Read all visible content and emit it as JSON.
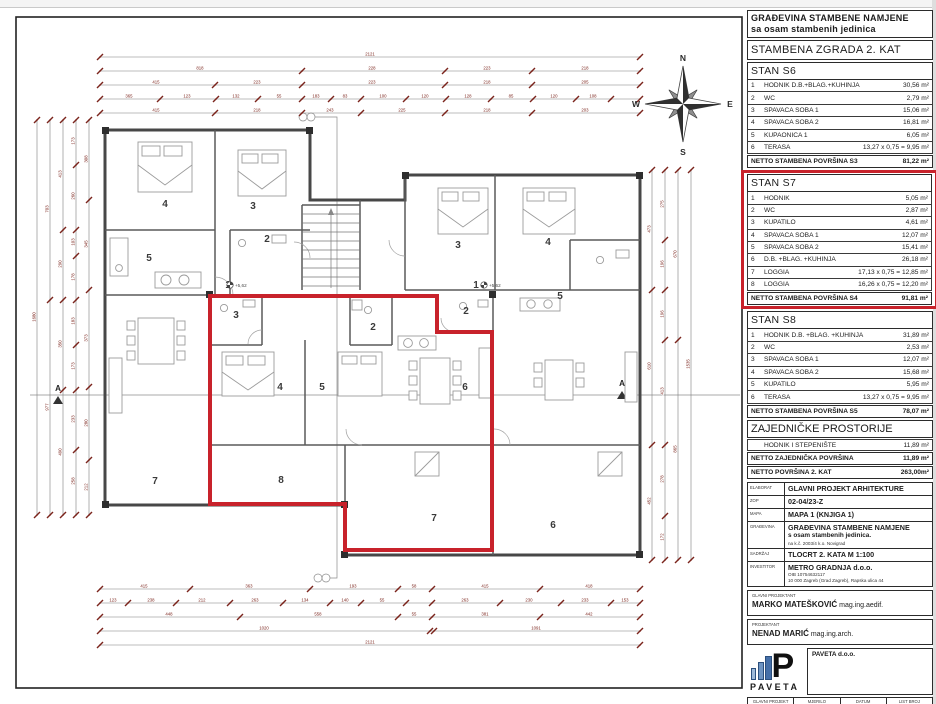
{
  "panel": {
    "header_line1": "GRAĐEVINA STAMBENE NAMJENE",
    "header_line2": "sa osam stambenih jedinica",
    "subtitle": "STAMBENA ZGRADA 2. KAT",
    "sections": [
      {
        "title": "STAN S6",
        "rows": [
          {
            "num": "1",
            "label": "HODNIK D.B.+BLAG.+KUHINJA",
            "area": "30,56 m²"
          },
          {
            "num": "2",
            "label": "WC",
            "area": "2,79 m²"
          },
          {
            "num": "3",
            "label": "SPAVAĆA SOBA 1",
            "area": "15,06 m²"
          },
          {
            "num": "4",
            "label": "SPAVAĆA SOBA 2",
            "area": "16,81 m²"
          },
          {
            "num": "5",
            "label": "KUPAONICA 1",
            "area": "6,05 m²"
          },
          {
            "num": "6",
            "label": "TERASA",
            "area": "13,27 x 0,75 = 9,95 m²"
          }
        ],
        "total_label": "NETTO STAMBENA POVRŠINA S3",
        "total_area": "81,22 m²"
      },
      {
        "title": "STAN S7",
        "rows": [
          {
            "num": "1",
            "label": "HODNIK",
            "area": "5,05 m²"
          },
          {
            "num": "2",
            "label": "WC",
            "area": "2,87 m²"
          },
          {
            "num": "3",
            "label": "KUPATILO",
            "area": "4,61 m²"
          },
          {
            "num": "4",
            "label": "SPAVAĆA SOBA 1",
            "area": "12,07 m²"
          },
          {
            "num": "5",
            "label": "SPAVAĆA SOBA 2",
            "area": "15,41 m²"
          },
          {
            "num": "6",
            "label": "D.B. +BLAG. +KUHINJA",
            "area": "26,18 m²"
          },
          {
            "num": "7",
            "label": "LOGGIA",
            "area": "17,13 x 0,75 = 12,85 m²"
          },
          {
            "num": "8",
            "label": "LOGGIA",
            "area": "16,26 x 0,75 = 12,20 m²"
          }
        ],
        "total_label": "NETTO STAMBENA POVRŠINA S4",
        "total_area": "91,81 m²"
      },
      {
        "title": "STAN S8",
        "rows": [
          {
            "num": "1",
            "label": "HODNIK D.B. +BLAG. +KUHINJA",
            "area": "31,89 m²"
          },
          {
            "num": "2",
            "label": "WC",
            "area": "2,53 m²"
          },
          {
            "num": "3",
            "label": "SPAVAĆA SOBA 1",
            "area": "12,07 m²"
          },
          {
            "num": "4",
            "label": "SPAVAĆA SOBA 2",
            "area": "15,68 m²"
          },
          {
            "num": "5",
            "label": "KUPATILO",
            "area": "5,95 m²"
          },
          {
            "num": "6",
            "label": "TERASA",
            "area": "13,27 x 0,75 = 9,95 m²"
          }
        ],
        "total_label": "NETTO STAMBENA POVRŠINA S5",
        "total_area": "78,07 m²"
      }
    ],
    "common": {
      "title": "ZAJEDNIČKE PROSTORIJE",
      "row_label": "HODNIK I STEPENIŠTE",
      "row_area": "11,89 m²",
      "total1_label": "NETTO ZAJEDNIČKA POVRŠINA",
      "total1_area": "11,89 m²",
      "total2_label": "NETTO POVRŠINA 2. KAT",
      "total2_area": "263,00m²"
    },
    "titleblock": {
      "k1": "ELABORAT",
      "v1": "GLAVNI PROJEKT ARHITEKTURE",
      "k2": "ZOP",
      "v2": "02-04/23-Z",
      "k3": "MAPA",
      "v3": "MAPA 1 (KNJIGA 1)",
      "k4": "GRAĐEVINA",
      "v4": "GRAĐEVINA STAMBENE NAMJENE",
      "v4b": "s osam stambenih jedinica.",
      "v4c": "na k.č. 2003/4 k.o. Novigrad",
      "k5": "SADRŽAJ",
      "v5": "TLOCRT 2. KATA M 1:100",
      "k6": "INVESTITOR",
      "v6": "METRO GRADNJA d.o.o.",
      "v6b": "OIB 10754632117",
      "v6c": "10 000 Zagreb (Grad Zagreb), Rapska ulica 44",
      "gp_label": "GLAVNI PROJEKTANT",
      "gp_name": "MARKO MATEŠKOVIĆ",
      "gp_title": " mag.ing.aedif.",
      "p_label": "PROJEKTANT",
      "p_name": "NENAD MARIĆ",
      "p_title": " mag.ing.arch.",
      "logo_letter": "P",
      "logo_word": "PAVETA",
      "company_name": "PAVETA d.o.o.",
      "company_lines": [
        "CRNTAVICA 35.",
        "GRŽEVIĆI, 52444 TINJAN",
        "tel. +385 91 529 1936",
        "e-mail: marko@pa-v.hr",
        "OIB: 27493677046"
      ],
      "footer": [
        {
          "label": "GLAVNI PROJEKT",
          "value": "02/04/2023"
        },
        {
          "label": "MJERILO",
          "value": "1:100"
        },
        {
          "label": "DATUM",
          "value": "05/2023"
        },
        {
          "label": "LIST BROJ",
          "value": "5"
        }
      ]
    }
  },
  "plan": {
    "colors": {
      "highlight": "#c8222b",
      "dimension": "#7b241c",
      "walls": "#474747"
    },
    "compass": [
      {
        "t": "N",
        "x": 683,
        "y": 61
      },
      {
        "t": "E",
        "x": 730,
        "y": 107
      },
      {
        "t": "S",
        "x": 683,
        "y": 155
      },
      {
        "t": "W",
        "x": 636,
        "y": 107
      }
    ],
    "rooms": [
      {
        "n": "4",
        "x": 165,
        "y": 207
      },
      {
        "n": "3",
        "x": 253,
        "y": 209
      },
      {
        "n": "5",
        "x": 149,
        "y": 261
      },
      {
        "n": "2",
        "x": 267,
        "y": 242
      },
      {
        "n": "1",
        "x": 228,
        "y": 288
      },
      {
        "n": "3",
        "x": 458,
        "y": 248
      },
      {
        "n": "4",
        "x": 548,
        "y": 245
      },
      {
        "n": "1",
        "x": 476,
        "y": 288
      },
      {
        "n": "5",
        "x": 560,
        "y": 299
      },
      {
        "n": "2",
        "x": 466,
        "y": 314
      },
      {
        "n": "3",
        "x": 236,
        "y": 318
      },
      {
        "n": "2",
        "x": 373,
        "y": 330
      },
      {
        "n": "4",
        "x": 280,
        "y": 390
      },
      {
        "n": "5",
        "x": 322,
        "y": 390
      },
      {
        "n": "6",
        "x": 465,
        "y": 390
      },
      {
        "n": "7",
        "x": 155,
        "y": 484
      },
      {
        "n": "8",
        "x": 281,
        "y": 483
      },
      {
        "n": "7",
        "x": 434,
        "y": 521
      },
      {
        "n": "6",
        "x": 553,
        "y": 528
      }
    ],
    "level_marks": [
      {
        "t": "+5,62",
        "x": 238,
        "y": 287
      },
      {
        "t": "+5,62",
        "x": 492,
        "y": 287
      }
    ],
    "section_letters": [
      {
        "t": "A",
        "x": 58,
        "y": 391
      },
      {
        "t": "A",
        "x": 622,
        "y": 386
      }
    ],
    "dim_lines": [
      {
        "o": "h",
        "p": 57,
        "a": 100,
        "b": 640,
        "t": [
          100,
          640
        ],
        "l": [
          [
            "2121",
            370
          ]
        ]
      },
      {
        "o": "h",
        "p": 71,
        "a": 100,
        "b": 640,
        "t": [
          100,
          302,
          445,
          532,
          640
        ],
        "l": [
          [
            "818",
            200
          ],
          [
            "228",
            372
          ],
          [
            "223",
            487
          ],
          [
            "218",
            585
          ]
        ]
      },
      {
        "o": "h",
        "p": 85,
        "a": 100,
        "b": 640,
        "t": [
          100,
          215,
          302,
          445,
          532,
          640
        ],
        "l": [
          [
            "415",
            156
          ],
          [
            "223",
            257
          ],
          [
            "223",
            372
          ],
          [
            "218",
            487
          ],
          [
            "205",
            585
          ]
        ]
      },
      {
        "o": "h",
        "p": 99,
        "a": 100,
        "b": 640,
        "t": [
          100,
          160,
          216,
          258,
          302,
          331,
          361,
          406,
          446,
          491,
          533,
          576,
          611,
          640
        ],
        "l": [
          [
            "365",
            129
          ],
          [
            "123",
            187
          ],
          [
            "132",
            236
          ],
          [
            "55",
            279
          ],
          [
            "183",
            316
          ],
          [
            "83",
            345
          ],
          [
            "100",
            383
          ],
          [
            "120",
            425
          ],
          [
            "128",
            468
          ],
          [
            "85",
            511
          ],
          [
            "120",
            554
          ],
          [
            "108",
            593
          ]
        ]
      },
      {
        "o": "h",
        "p": 113,
        "a": 100,
        "b": 640,
        "t": [
          100,
          215,
          302,
          361,
          445,
          532,
          640
        ],
        "l": [
          [
            "415",
            156
          ],
          [
            "218",
            257
          ],
          [
            "243",
            330
          ],
          [
            "225",
            402
          ],
          [
            "218",
            487
          ],
          [
            "203",
            585
          ]
        ]
      },
      {
        "o": "h",
        "p": 589,
        "a": 100,
        "b": 640,
        "t": [
          100,
          190,
          310,
          398,
          432,
          540,
          640
        ],
        "l": [
          [
            "415",
            144
          ],
          [
            "363",
            249
          ],
          [
            "193",
            353
          ],
          [
            "58",
            414
          ],
          [
            "415",
            485
          ],
          [
            "418",
            589
          ]
        ]
      },
      {
        "o": "h",
        "p": 603,
        "a": 100,
        "b": 640,
        "t": [
          100,
          128,
          176,
          230,
          283,
          330,
          361,
          406,
          432,
          500,
          561,
          611,
          640
        ],
        "l": [
          [
            "123",
            113
          ],
          [
            "238",
            151
          ],
          [
            "212",
            202
          ],
          [
            "263",
            255
          ],
          [
            "134",
            305
          ],
          [
            "140",
            345
          ],
          [
            "55",
            382
          ],
          [
            "263",
            465
          ],
          [
            "230",
            529
          ],
          [
            "233",
            585
          ],
          [
            "153",
            625
          ]
        ]
      },
      {
        "o": "h",
        "p": 617,
        "a": 100,
        "b": 640,
        "t": [
          100,
          240,
          398,
          432,
          540,
          640
        ],
        "l": [
          [
            "448",
            169
          ],
          [
            "558",
            318
          ],
          [
            "55",
            414
          ],
          [
            "381",
            485
          ],
          [
            "442",
            589
          ]
        ]
      },
      {
        "o": "h",
        "p": 631,
        "a": 100,
        "b": 640,
        "t": [
          100,
          430,
          434,
          640
        ],
        "l": [
          [
            "1020",
            264
          ],
          [
            "1091",
            536
          ]
        ]
      },
      {
        "o": "h",
        "p": 645,
        "a": 100,
        "b": 640,
        "t": [
          100,
          640
        ],
        "l": [
          [
            "2121",
            370
          ]
        ]
      },
      {
        "o": "v",
        "p": 37,
        "a": 120,
        "b": 515,
        "t": [
          120,
          515
        ],
        "l": [
          [
            "1680",
            317
          ]
        ]
      },
      {
        "o": "v",
        "p": 50,
        "a": 120,
        "b": 515,
        "t": [
          120,
          300,
          515
        ],
        "l": [
          [
            "703",
            209
          ],
          [
            "977",
            407
          ]
        ]
      },
      {
        "o": "v",
        "p": 63,
        "a": 120,
        "b": 515,
        "t": [
          120,
          230,
          300,
          390,
          515
        ],
        "l": [
          [
            "413",
            174
          ],
          [
            "290",
            264
          ],
          [
            "350",
            344
          ],
          [
            "490",
            452
          ]
        ]
      },
      {
        "o": "v",
        "p": 76,
        "a": 120,
        "b": 515,
        "t": [
          120,
          165,
          230,
          256,
          300,
          345,
          390,
          450,
          515
        ],
        "l": [
          [
            "173",
            141
          ],
          [
            "260",
            196
          ],
          [
            "103",
            242
          ],
          [
            "178",
            277
          ],
          [
            "183",
            321
          ],
          [
            "173",
            366
          ],
          [
            "233",
            419
          ],
          [
            "258",
            481
          ]
        ]
      },
      {
        "o": "v",
        "p": 89,
        "a": 120,
        "b": 515,
        "t": [
          120,
          200,
          290,
          387,
          460,
          515
        ],
        "l": [
          [
            "308",
            159
          ],
          [
            "345",
            244
          ],
          [
            "373",
            338
          ],
          [
            "280",
            423
          ],
          [
            "212",
            487
          ]
        ]
      },
      {
        "o": "v",
        "p": 652,
        "a": 170,
        "b": 560,
        "t": [
          170,
          290,
          445,
          560
        ],
        "l": [
          [
            "473",
            229
          ],
          [
            "610",
            366
          ],
          [
            "452",
            501
          ]
        ]
      },
      {
        "o": "v",
        "p": 665,
        "a": 170,
        "b": 560,
        "t": [
          170,
          240,
          290,
          340,
          445,
          516,
          560
        ],
        "l": [
          [
            "275",
            204
          ],
          [
            "196",
            264
          ],
          [
            "196",
            314
          ],
          [
            "413",
            391
          ],
          [
            "278",
            479
          ],
          [
            "172",
            537
          ]
        ]
      },
      {
        "o": "v",
        "p": 678,
        "a": 170,
        "b": 560,
        "t": [
          170,
          340,
          560
        ],
        "l": [
          [
            "670",
            254
          ],
          [
            "865",
            449
          ]
        ]
      },
      {
        "o": "v",
        "p": 691,
        "a": 170,
        "b": 560,
        "t": [
          170,
          560
        ],
        "l": [
          [
            "1535",
            364
          ]
        ]
      }
    ]
  }
}
